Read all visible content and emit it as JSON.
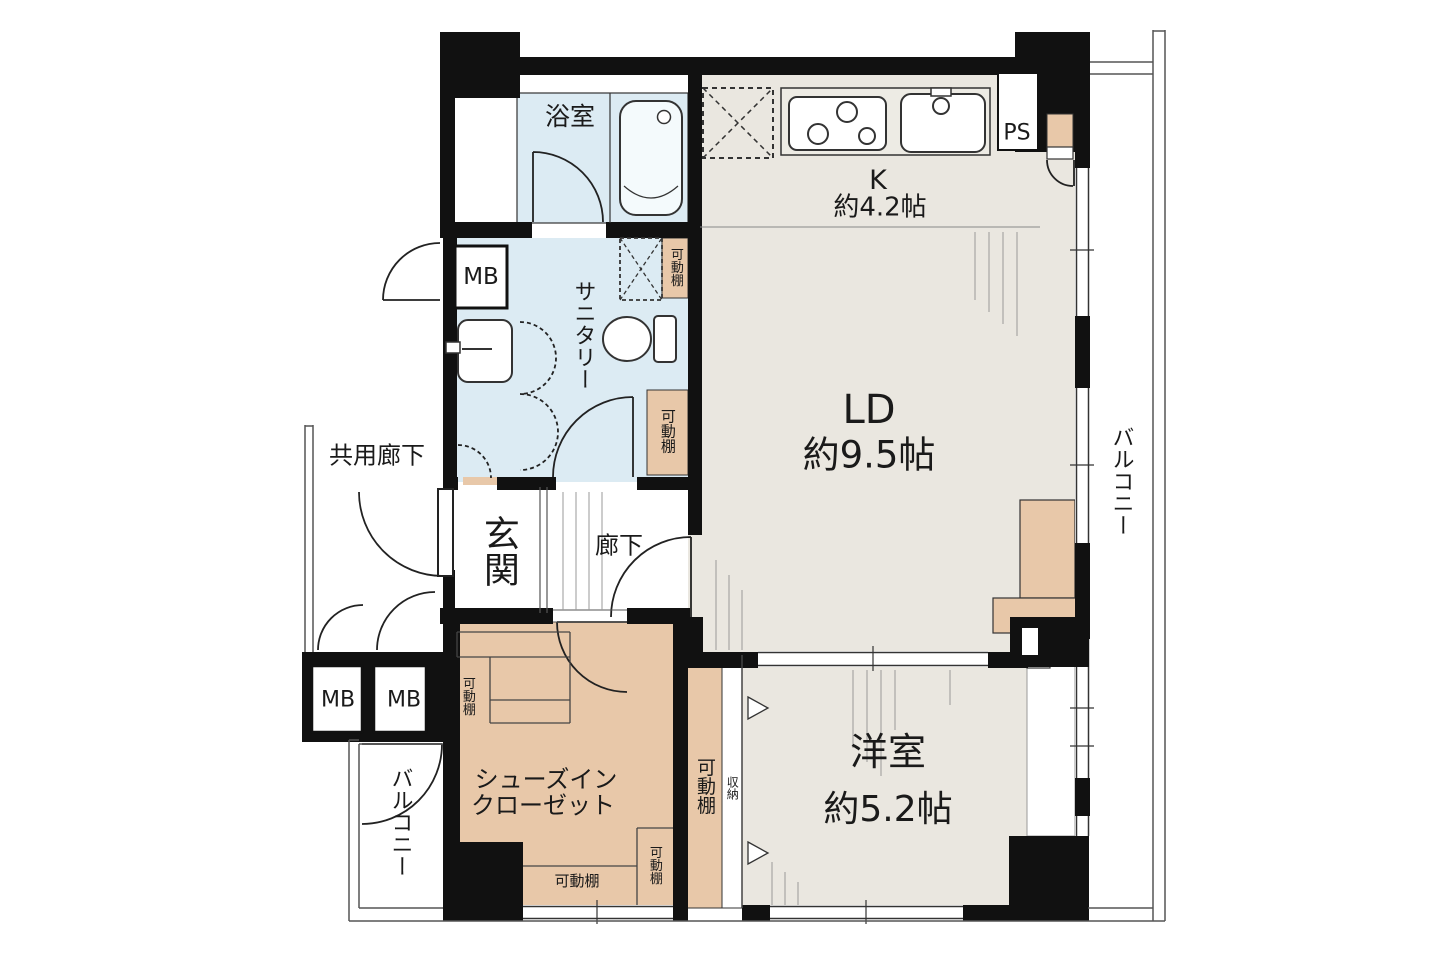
{
  "plan_type": "apartment-floor-plan",
  "rooms": {
    "bathroom": {
      "name": "浴室"
    },
    "kitchen": {
      "name": "K",
      "size": "約4.2帖"
    },
    "living_dining": {
      "name": "LD",
      "size": "約9.5帖"
    },
    "sanitary": {
      "name": "サニタリー"
    },
    "entrance": {
      "name": "玄関"
    },
    "hallway": {
      "name": "廊下"
    },
    "common_corridor": {
      "name": "共用廊下"
    },
    "shoes_in_closet": {
      "name_line1": "シューズイン",
      "name_line2": "クローゼット"
    },
    "western_room": {
      "name": "洋室",
      "size": "約5.2帖"
    },
    "balcony_right": {
      "name": "バルコニー"
    },
    "balcony_bottom_left": {
      "name": "バルコニー"
    }
  },
  "labels": {
    "ps": "PS",
    "mb_top": "MB",
    "mb_bottom_1": "MB",
    "mb_bottom_2": "MB",
    "storage": "収納",
    "shelf_sanitary_top": "可動棚",
    "shelf_sanitary_right": "可動棚",
    "shelf_sic_left": "可動棚",
    "shelf_sic_bottom": "可動棚",
    "shelf_sic_right": "可動棚",
    "shelf_western_closet": "可動棚"
  },
  "colors": {
    "wall": "#111111",
    "floor_main": "#eae7e0",
    "floor_wet": "#dcebf3",
    "floor_closet": "#e8c8a9",
    "fixture_stroke": "#333333",
    "balcony_line": "#555555"
  }
}
